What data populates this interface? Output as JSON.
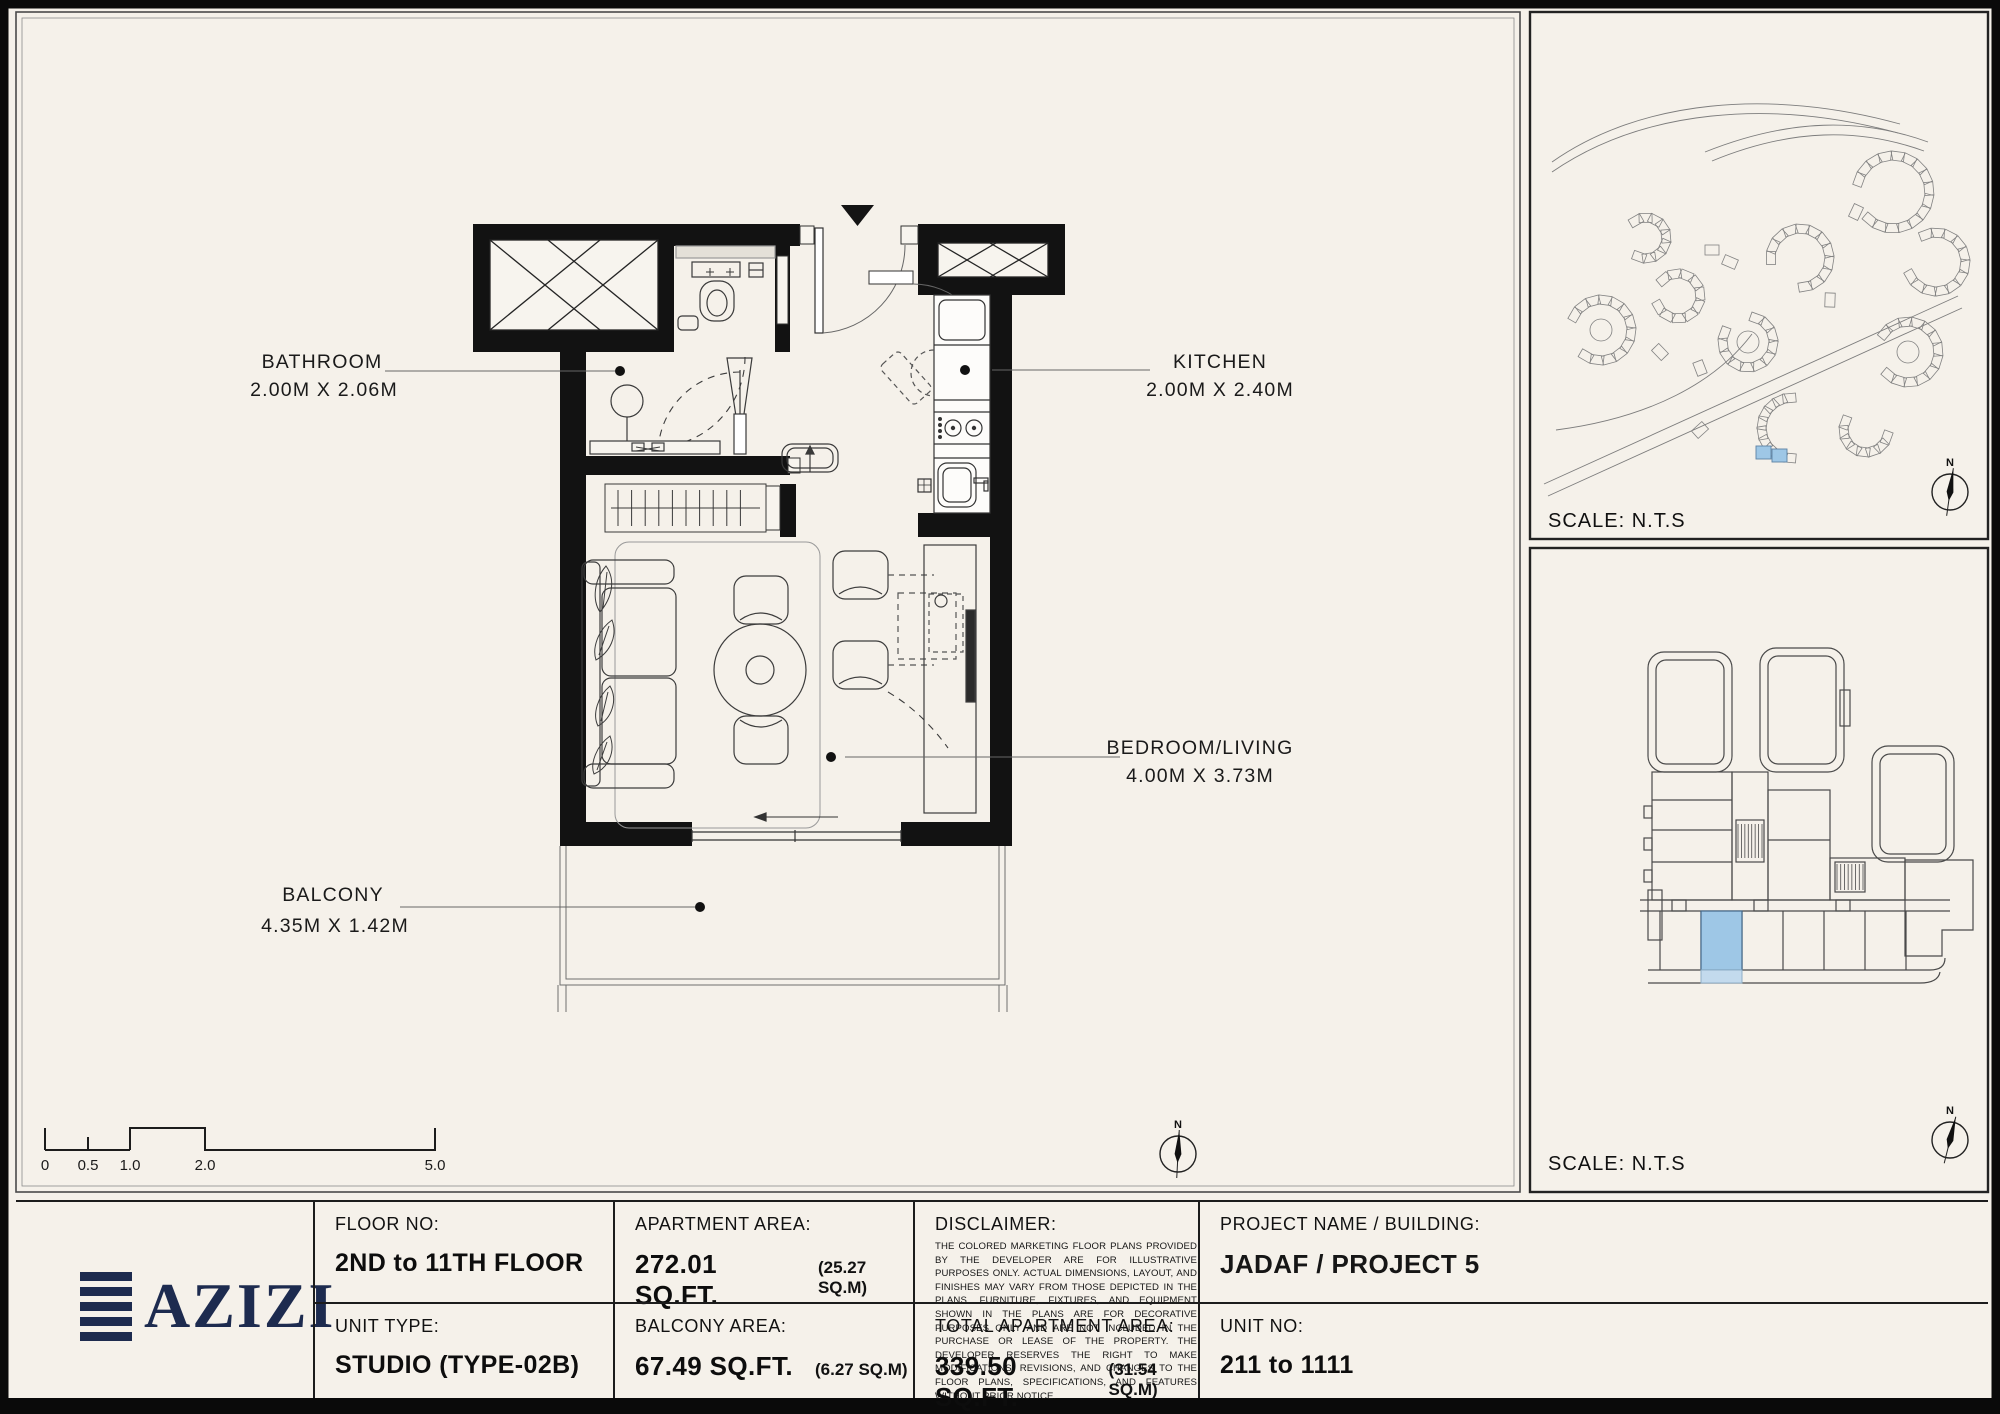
{
  "plan": {
    "rooms": [
      {
        "name": "BATHROOM",
        "dims": "2.00M X 2.06M"
      },
      {
        "name": "KITCHEN",
        "dims": "2.00M X 2.40M"
      },
      {
        "name": "BEDROOM/LIVING",
        "dims": "4.00M X 3.73M"
      },
      {
        "name": "BALCONY",
        "dims": "4.35M X 1.42M"
      }
    ]
  },
  "scalebar": {
    "ticks": [
      "0",
      "0.5",
      "1.0",
      "2.0",
      "5.0"
    ]
  },
  "panels": {
    "site_scale": "SCALE: N.T.S",
    "building_scale": "SCALE: N.T.S",
    "compass_n": "N",
    "highlight_color": "#9ec7e6"
  },
  "titleblock": {
    "logo": "AZIZI",
    "floor_label": "FLOOR NO:",
    "floor_value": "2ND to 11TH FLOOR",
    "unit_type_label": "UNIT TYPE:",
    "unit_type_value": "STUDIO (TYPE-02B)",
    "apt_area_label": "APARTMENT AREA:",
    "apt_area_value": "272.01 SQ.FT.",
    "apt_area_sub": "(25.27 SQ.M)",
    "balcony_area_label": "BALCONY AREA:",
    "balcony_area_value": "67.49 SQ.FT.",
    "balcony_area_sub": "(6.27 SQ.M)",
    "disclaimer_label": "DISCLAIMER:",
    "disclaimer_text": "THE COLORED MARKETING FLOOR PLANS PROVIDED BY THE DEVELOPER ARE FOR ILLUSTRATIVE PURPOSES ONLY. ACTUAL DIMENSIONS, LAYOUT, AND FINISHES MAY VARY FROM THOSE DEPICTED IN THE PLANS. FURNITURE, FIXTURES, AND EQUIPMENT SHOWN IN THE PLANS ARE FOR DECORATIVE PURPOSES ONLY AND ARE NOT INCLUDED IN THE PURCHASE OR LEASE OF THE PROPERTY. THE DEVELOPER RESERVES THE RIGHT TO MAKE MODIFICATIONS, REVISIONS, AND CHANGES TO THE FLOOR PLANS, SPECIFICATIONS, AND FEATURES WITHOUT PRIOR NOTICE.",
    "total_area_label": "TOTAL APARTMENT AREA:",
    "total_area_value": "339.50 SQ.FT.",
    "total_area_sub": "(31.54 SQ.M)",
    "project_label": "PROJECT NAME / BUILDING:",
    "project_value": "JADAF / PROJECT 5",
    "unit_no_label": "UNIT NO:",
    "unit_no_value": "211 to 1111"
  }
}
